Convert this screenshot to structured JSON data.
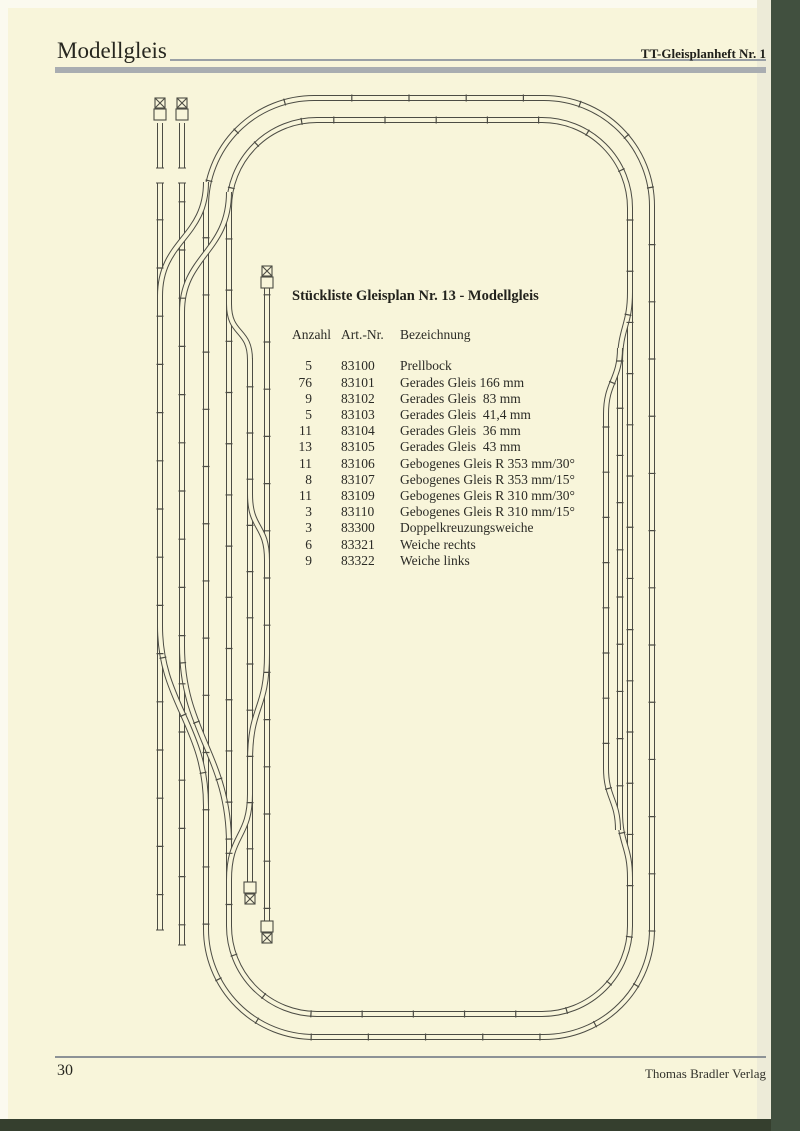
{
  "header": {
    "left_title": "Modellgleis",
    "right_title": "TT-Gleisplanheft Nr. 1"
  },
  "parts_list": {
    "title": "Stückliste Gleisplan Nr. 13 - Modellgleis",
    "columns": [
      "Anzahl",
      "Art.-Nr.",
      "Bezeichnung"
    ],
    "rows": [
      {
        "n": "5",
        "art": "83100",
        "name": "Prellbock"
      },
      {
        "n": "76",
        "art": "83101",
        "name": "Gerades Gleis 166 mm"
      },
      {
        "n": "9",
        "art": "83102",
        "name": "Gerades Gleis  83 mm"
      },
      {
        "n": "5",
        "art": "83103",
        "name": "Gerades Gleis  41,4 mm"
      },
      {
        "n": "11",
        "art": "83104",
        "name": "Gerades Gleis  36 mm"
      },
      {
        "n": "13",
        "art": "83105",
        "name": "Gerades Gleis  43 mm"
      },
      {
        "n": "11",
        "art": "83106",
        "name": "Gebogenes Gleis R 353 mm/30°"
      },
      {
        "n": "8",
        "art": "83107",
        "name": "Gebogenes Gleis R 353 mm/15°"
      },
      {
        "n": "11",
        "art": "83109",
        "name": "Gebogenes Gleis R 310 mm/30°"
      },
      {
        "n": "3",
        "art": "83110",
        "name": "Gebogenes Gleis R 310 mm/15°"
      },
      {
        "n": "3",
        "art": "83300",
        "name": "Doppelkreuzungsweiche"
      },
      {
        "n": "6",
        "art": "83321",
        "name": "Weiche rechts"
      },
      {
        "n": "9",
        "art": "83322",
        "name": "Weiche links"
      }
    ]
  },
  "footer": {
    "page_number": "30",
    "publisher": "Thomas Bradler Verlag"
  },
  "diagram": {
    "kind": "model-railway-track-plan",
    "buffer_stop_icon": "crossed-box",
    "buffer_stop_count": 5
  },
  "colors": {
    "page_bg": "#f8f5da",
    "header_bar": "#a9adb1",
    "track_line": "#4c4c44",
    "book_edge_green": "#41503f"
  }
}
